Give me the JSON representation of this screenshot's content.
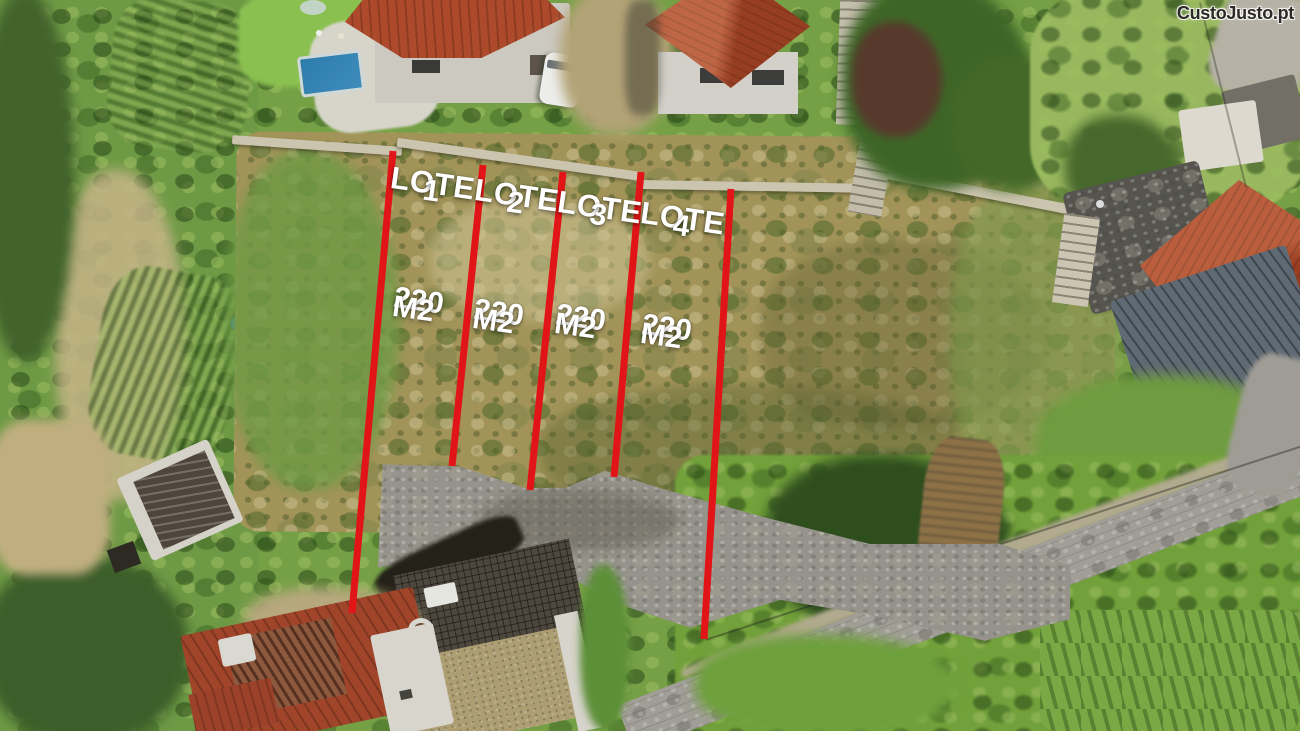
{
  "watermark": {
    "text": "CustoJusto.pt"
  },
  "listing": {
    "lots": [
      {
        "label": "LOTE",
        "number": "1",
        "area": "220",
        "unit": "M2"
      },
      {
        "label": "LOTE",
        "number": "2",
        "area": "220",
        "unit": "M2"
      },
      {
        "label": "LOTE",
        "number": "3",
        "area": "220",
        "unit": "M2"
      },
      {
        "label": "LOTE",
        "number": "4",
        "area": "220",
        "unit": "M2"
      }
    ]
  },
  "annotations": {
    "line_color": "#e11517",
    "label_color": "#ffffff",
    "boundary_lines": [
      {
        "x1": 393,
        "y1": 151,
        "x2": 352,
        "y2": 613
      },
      {
        "x1": 483,
        "y1": 165,
        "x2": 452,
        "y2": 466
      },
      {
        "x1": 563,
        "y1": 172,
        "x2": 530,
        "y2": 490
      },
      {
        "x1": 641,
        "y1": 172,
        "x2": 614,
        "y2": 477
      },
      {
        "x1": 731,
        "y1": 189,
        "x2": 704,
        "y2": 639
      }
    ]
  }
}
